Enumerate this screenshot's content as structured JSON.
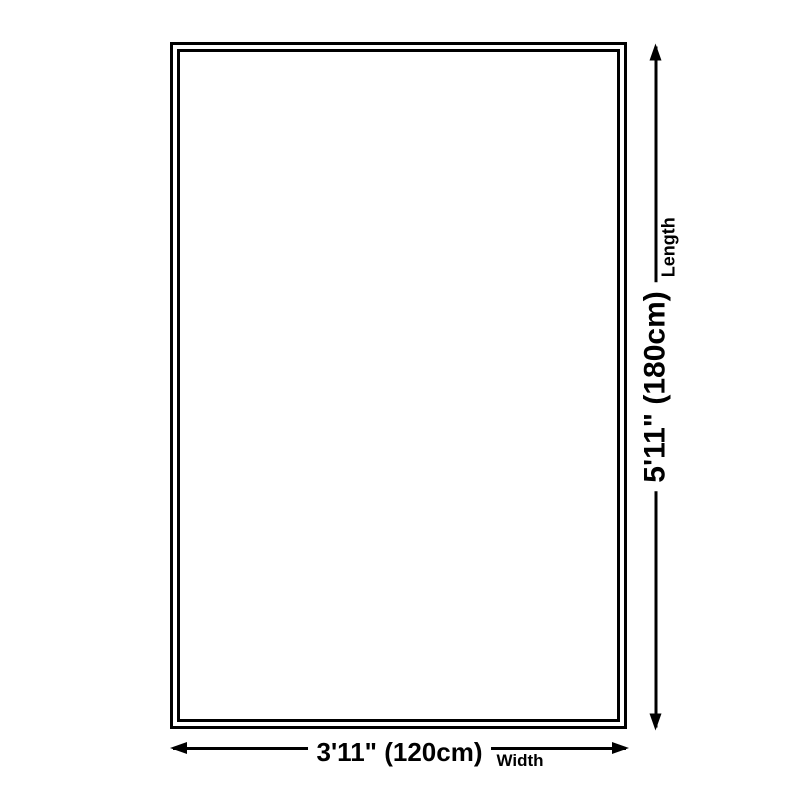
{
  "colors": {
    "background": "#ffffff",
    "line": "#000000",
    "text": "#000000"
  },
  "dimensions": {
    "width": {
      "value": "3'11\" (120cm)",
      "label": "Width"
    },
    "length": {
      "value": "5'11\" (180cm)",
      "label": "Length"
    }
  }
}
